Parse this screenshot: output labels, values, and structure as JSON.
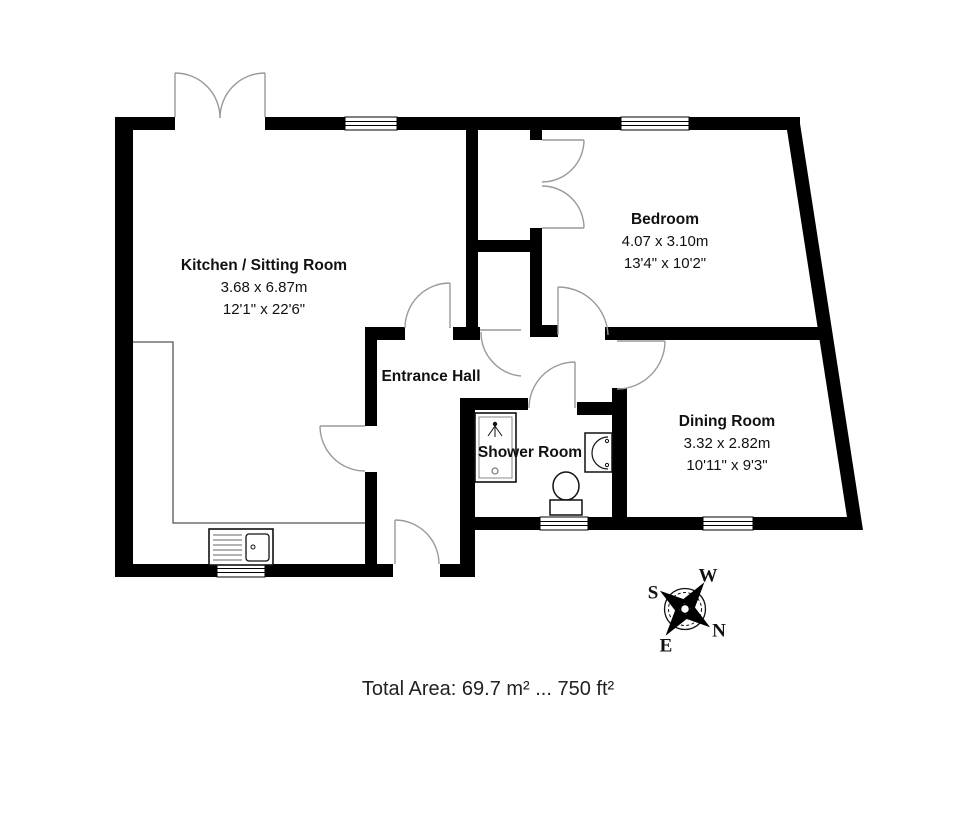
{
  "plan": {
    "rooms": [
      {
        "name": "Kitchen / Sitting Room",
        "metric": "3.68 x 6.87m",
        "imperial": "12'1\" x 22'6\""
      },
      {
        "name": "Bedroom",
        "metric": "4.07 x 3.10m",
        "imperial": "13'4\" x 10'2\""
      },
      {
        "name": "Entrance Hall"
      },
      {
        "name": "Shower Room"
      },
      {
        "name": "Dining Room",
        "metric": "3.32 x 2.82m",
        "imperial": "10'11\" x 9'3\""
      }
    ],
    "compass": {
      "n": "N",
      "s": "S",
      "e": "E",
      "w": "W"
    },
    "footer": {
      "total_area": "Total Area: 69.7 m² ... 750 ft²"
    },
    "icons": [
      "window-icon",
      "door-swing-icon",
      "double-door-icon",
      "shower-cubicle-icon",
      "toilet-icon",
      "wash-basin-icon",
      "kitchen-sink-icon",
      "compass-rose-icon"
    ],
    "colors": {
      "wall": "#000000",
      "background": "#ffffff",
      "door_arc": "#9a9a9a",
      "fixture": "#1a1a1a",
      "text": "#111111"
    }
  }
}
